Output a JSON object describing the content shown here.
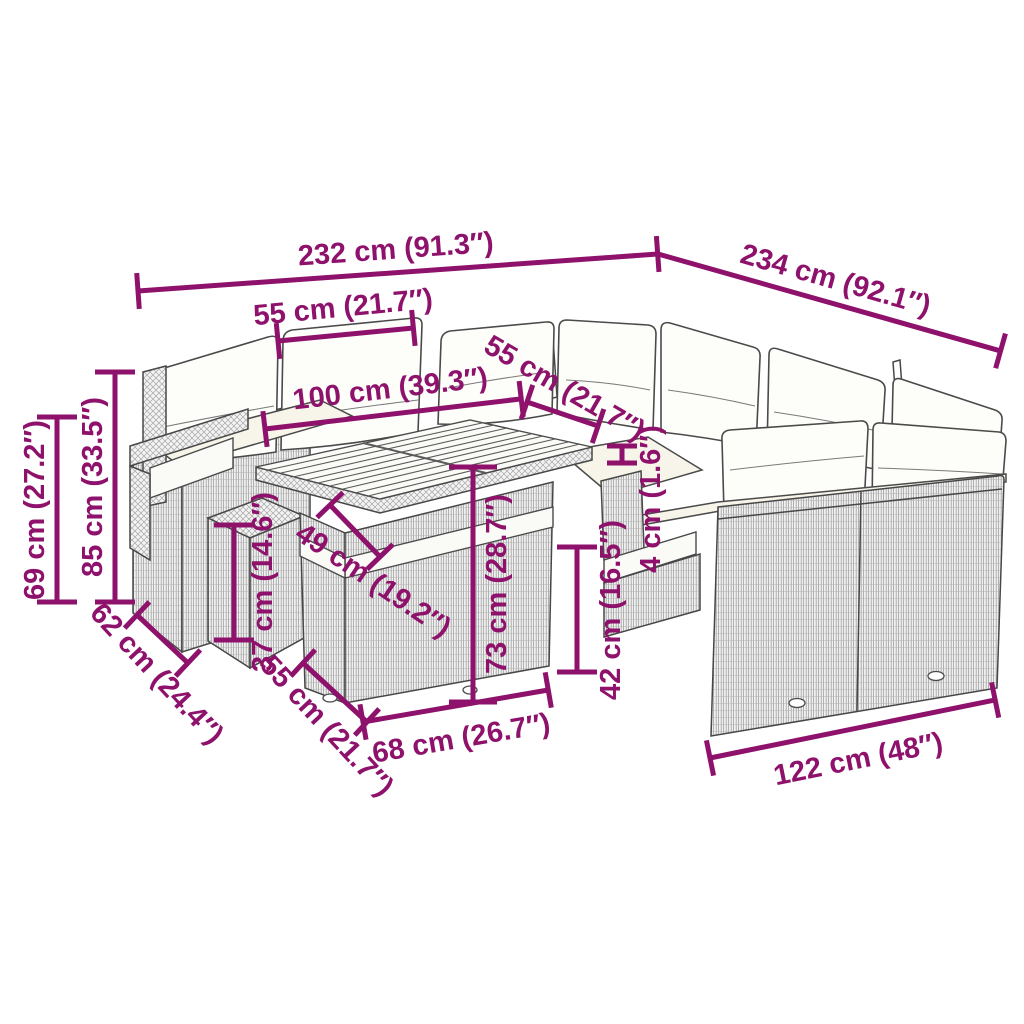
{
  "diagram": {
    "accent_color": "#8E116B",
    "product_kind": "garden-lounge-set-dimension-diagram",
    "dimensions": {
      "overall_width_back_left": "232 cm (91.3″)",
      "overall_width_back_right": "234 cm (92.1″)",
      "back_section_width": "55 cm (21.7″)",
      "table_top_length": "100 cm (39.3″)",
      "seat_depth_right": "55 cm (21.7″)",
      "armrest_height": "69 cm (27.2″)",
      "total_height": "85 cm (33.5″)",
      "seat_depth_left": "62 cm (24.4″)",
      "ottoman_height": "37 cm (14.6″)",
      "table_top_depth": "49 cm (19.2″)",
      "ottoman_width": "55 cm (21.7″)",
      "table_length_front": "68 cm (26.7″)",
      "table_height": "73 cm (28.7″)",
      "seat_height": "42 cm (16.5″)",
      "frame_detail_thickness": "4 cm (1.6″)",
      "right_section_width": "122 cm (48″)"
    }
  }
}
